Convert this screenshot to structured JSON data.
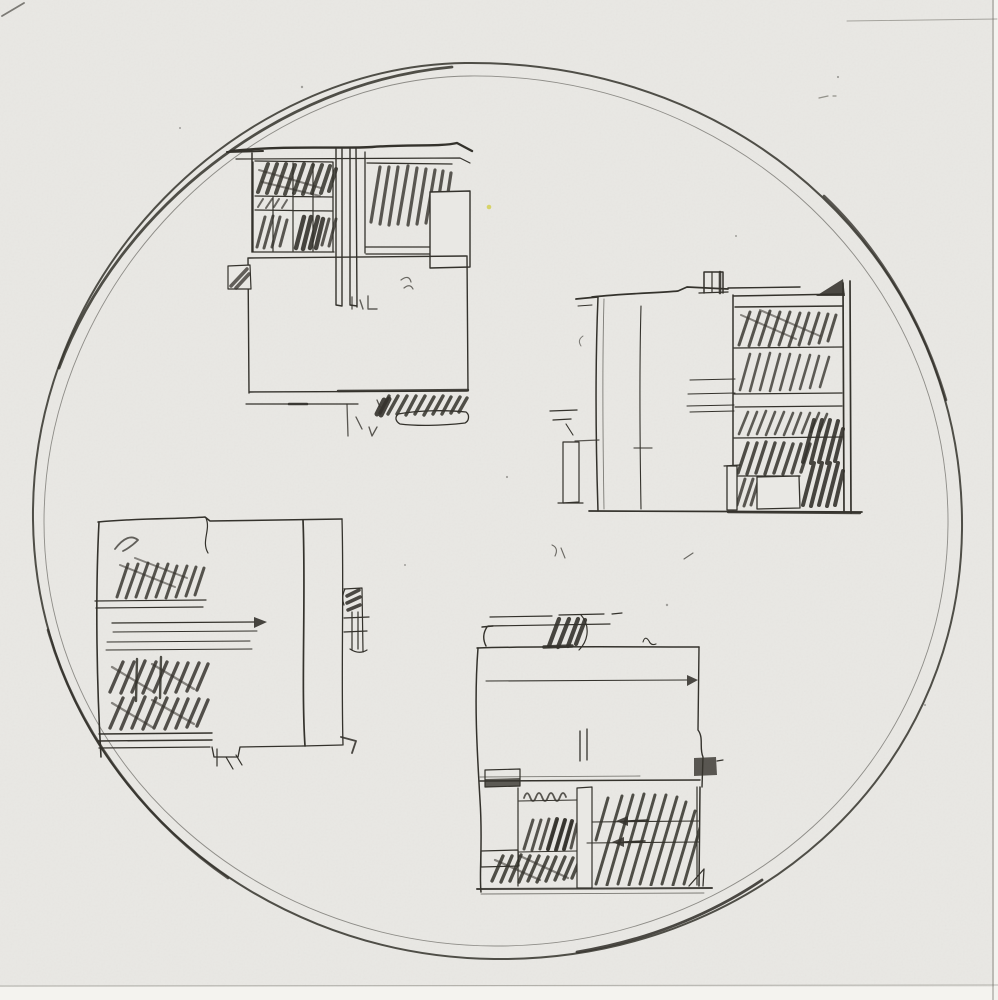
{
  "artwork": {
    "title": "Freehand pencil sketch: four modernist building elevations arranged inside a large hand-drawn circle",
    "medium": "graphite on paper (scanned)",
    "colors": {
      "paper": "#e9e8e4",
      "paper_edge": "#f4f3ef",
      "ink": "#34322c",
      "ink_soft": "#6e6c64",
      "speck_yellow": "#d4cf52"
    },
    "circle": {
      "cx": 497,
      "cy": 512,
      "rx": 466,
      "ry": 448,
      "style": "freehand, double-traced stroke with darker retraced segments"
    },
    "sketches": [
      {
        "id": "top-left",
        "description": "Elevation with gridded window band of heavy scribbled glazing, twin white mullion strips, long blank wall below, hatched plinth strip and small rounded bar at lower right",
        "bbox": [
          227,
          140,
          250,
          300
        ]
      },
      {
        "id": "top-right",
        "description": "Tall elevation: blank left wing with chimney stack, right bay of hatched strip windows over a dark hatched base with small white panel and pilaster",
        "bbox": [
          550,
          268,
          312,
          292
        ]
      },
      {
        "id": "bottom-left",
        "description": "Elevation with hatched left bay in two tiers, arrowed datum lines, blank right wing, small balcony appendage at right and notched ground line",
        "bbox": [
          95,
          513,
          290,
          258
        ]
      },
      {
        "id": "bottom-center",
        "description": "Elevation with blank upper wall, small dark hatched block on the parapet, arrowed datum line, hatched lower storey split by a white mullion, dark flag at right edge",
        "bbox": [
          475,
          612,
          248,
          285
        ]
      }
    ],
    "marks": [
      {
        "id": "corner-scratch-top-left",
        "x": 2,
        "y": 16
      },
      {
        "id": "scratch-line-top-right",
        "y": 20
      },
      {
        "id": "paper-edge-right",
        "x": 993
      },
      {
        "id": "paper-edge-bottom",
        "y": 986
      },
      {
        "id": "yellow-speck",
        "x": 489,
        "y": 207
      }
    ]
  }
}
